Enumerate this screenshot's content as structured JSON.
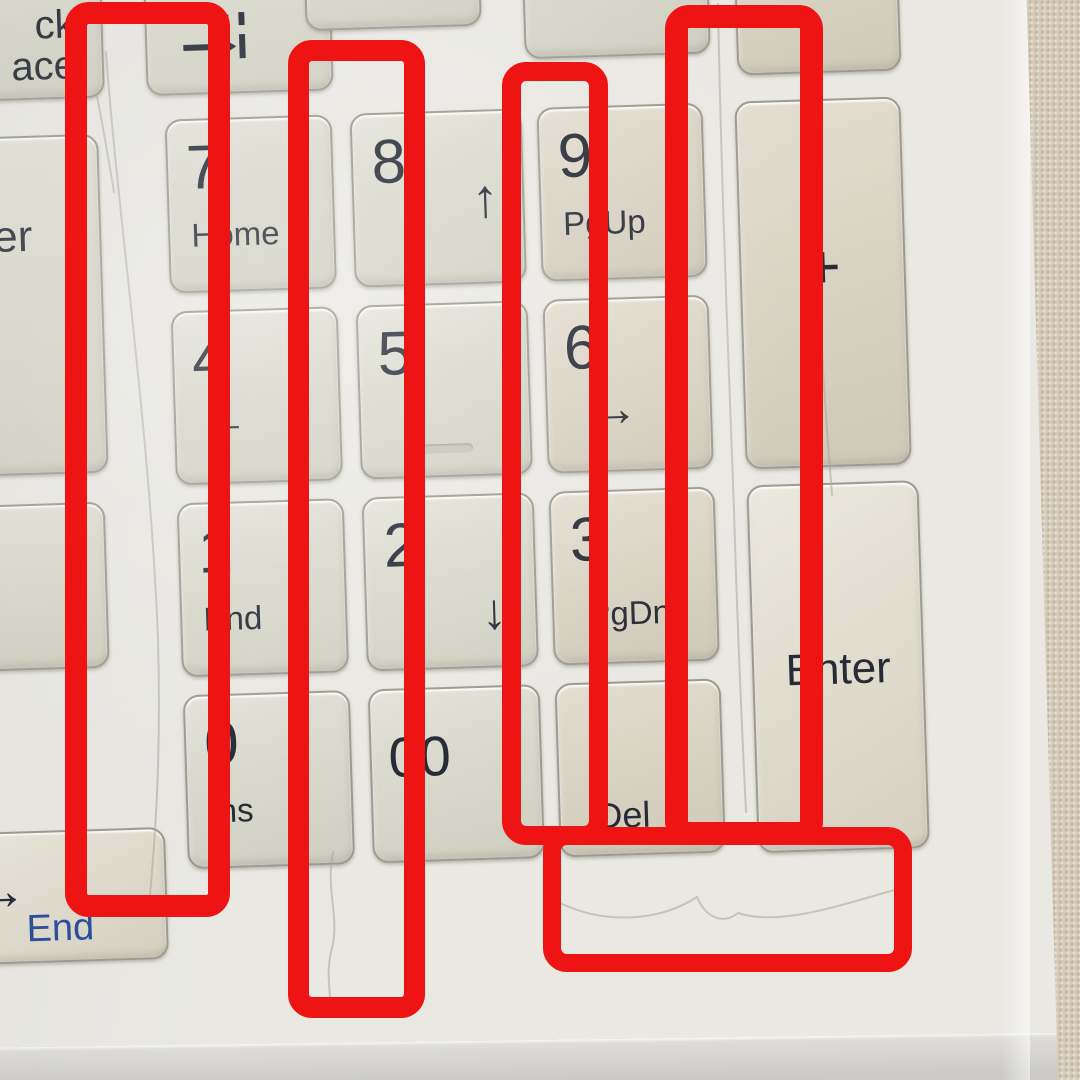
{
  "photo": {
    "description_colors": {
      "deck": "#e9e8e3",
      "fabric": "#d5ccbb",
      "legend": "#262b36",
      "fn_legend_blue": "#2b4d9b"
    }
  },
  "keyboard": {
    "rotation_deg": -1.8,
    "keys": [
      {
        "name": "key-7",
        "box": [
          178,
          108,
          163,
          170
        ],
        "main": "7",
        "sub": "Home",
        "tint": "cool"
      },
      {
        "name": "key-8",
        "box": [
          363,
          108,
          168,
          170
        ],
        "main": "8",
        "sub": "↑",
        "sub_class": "arr-up",
        "tint": "cool"
      },
      {
        "name": "key-9",
        "box": [
          550,
          108,
          162,
          170
        ],
        "main": "9",
        "sub": "PgUp",
        "tint": "warm"
      },
      {
        "name": "key-plus",
        "box": [
          748,
          108,
          162,
          364
        ],
        "main": "+",
        "main_class": "plus",
        "tint": "warm"
      },
      {
        "name": "key-4",
        "box": [
          178,
          300,
          163,
          170
        ],
        "main": "4",
        "sub": "←",
        "sub_class": "arr-left",
        "tint": "cool"
      },
      {
        "name": "key-5",
        "box": [
          363,
          300,
          168,
          170
        ],
        "main": "5",
        "nub": true,
        "tint": "cool"
      },
      {
        "name": "key-6",
        "box": [
          550,
          300,
          162,
          170
        ],
        "main": "6",
        "sub": "→",
        "sub_class": "arr-right",
        "tint": "warm"
      },
      {
        "name": "key-1",
        "box": [
          178,
          492,
          163,
          170
        ],
        "main": "1",
        "sub": "End",
        "tint": "cool"
      },
      {
        "name": "key-2",
        "box": [
          363,
          492,
          168,
          170
        ],
        "main": "2",
        "sub": "↓",
        "sub_class": "arr-down",
        "tint": "cool"
      },
      {
        "name": "key-3",
        "box": [
          550,
          492,
          162,
          170
        ],
        "main": "3",
        "sub": "PgDn",
        "sub_class": "sub-mid",
        "tint": "warm"
      },
      {
        "name": "key-enter",
        "box": [
          748,
          492,
          168,
          364
        ],
        "main": "Enter",
        "main_class": "enter-label",
        "tint": "bright"
      },
      {
        "name": "key-0",
        "box": [
          178,
          684,
          163,
          170
        ],
        "main": "0",
        "sub": "Ins",
        "tint": "cool"
      },
      {
        "name": "key-00",
        "box": [
          363,
          684,
          168,
          170
        ],
        "main": "00",
        "main_class": "num00",
        "tint": "cool"
      },
      {
        "name": "key-del",
        "box": [
          550,
          684,
          162,
          170
        ],
        "main": "Del",
        "main_class": "del-label",
        "tint": "warm"
      },
      {
        "name": "key-backspace-partial",
        "box": [
          -40,
          -70,
          155,
          150
        ],
        "lines": [
          "ck",
          "ace"
        ],
        "tint": "cool"
      },
      {
        "name": "key-tab-partial",
        "box": [
          161,
          -65,
          183,
          145
        ],
        "glyph": "tab",
        "tint": "cool"
      },
      {
        "name": "key-enter-main-partial",
        "box": [
          -45,
          120,
          152,
          335
        ],
        "main": "er",
        "main_class": "er-label",
        "tint": "cool"
      },
      {
        "name": "key-blank-partial",
        "box": [
          -45,
          488,
          147,
          162
        ],
        "tint": "cool"
      },
      {
        "name": "key-arrow-end-partial",
        "box": [
          -50,
          815,
          202,
          128
        ],
        "main": "→",
        "main_class": "arrow-end",
        "sub": "End",
        "sub_class": "blue-end",
        "tint": "bright"
      },
      {
        "name": "key-sliver-top-1",
        "box": [
          322,
          -152,
          172,
          172
        ],
        "tint": "cool"
      },
      {
        "name": "key-sliver-top-2",
        "box": [
          540,
          -117,
          182,
          172
        ],
        "tint": "cool"
      },
      {
        "name": "key-sliver-top-3",
        "box": [
          752,
          -94,
          160,
          172
        ],
        "tint": "warm"
      }
    ]
  },
  "annotations": {
    "color": "#ee1414",
    "rects": [
      {
        "name": "highlight-rect-1",
        "box": [
          65,
          2,
          165,
          915
        ],
        "stroke": 22
      },
      {
        "name": "highlight-rect-2",
        "box": [
          288,
          40,
          137,
          978
        ],
        "stroke": 21
      },
      {
        "name": "highlight-rect-3",
        "box": [
          502,
          62,
          106,
          783
        ],
        "stroke": 19
      },
      {
        "name": "highlight-rect-4",
        "box": [
          665,
          5,
          158,
          840
        ],
        "stroke": 23
      },
      {
        "name": "highlight-rect-5",
        "box": [
          543,
          827,
          369,
          145
        ],
        "stroke": 18
      }
    ]
  },
  "scratches": [
    {
      "d": "M106,52 C118,220 150,430 158,640 C162,780 152,868 149,908"
    },
    {
      "d": "M97,96 C104,132 109,162 114,192"
    },
    {
      "d": "M333,852 C325,892 341,918 331,952 C325,978 333,998 329,1014"
    },
    {
      "d": "M718,4 C721,170 728,350 734,510 C738,650 743,750 746,812"
    },
    {
      "d": "M560,903 C608,926 662,920 697,897 C706,918 723,925 738,913 C784,928 854,900 899,889"
    },
    {
      "d": "M822,350 C825,410 829,455 832,495"
    }
  ]
}
